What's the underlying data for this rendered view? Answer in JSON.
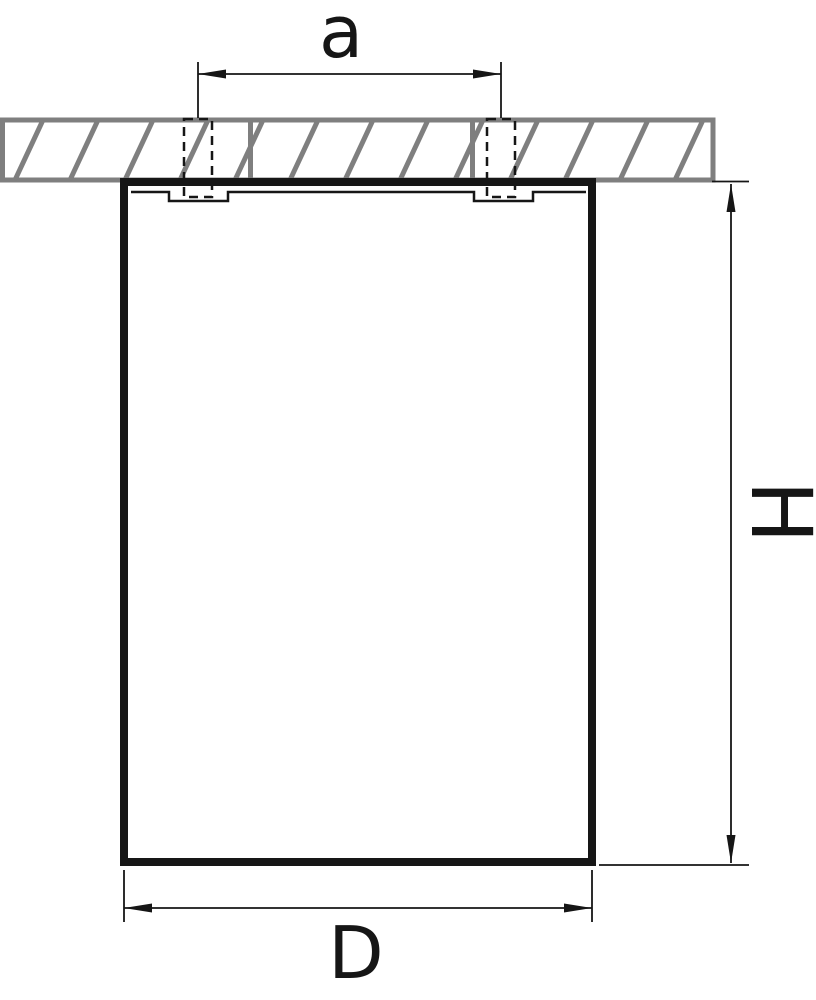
{
  "drawing": {
    "kind": "technical-dimension-drawing",
    "subject": "cylindrical ceiling-mounted fixture, side view with mounting holes",
    "colors": {
      "background": "#ffffff",
      "line": "#161616",
      "ceiling_hatch": "#7f7f7f",
      "fill": "#ffffff"
    },
    "labels": {
      "hole_spacing": "a",
      "height": "H",
      "diameter": "D"
    }
  }
}
